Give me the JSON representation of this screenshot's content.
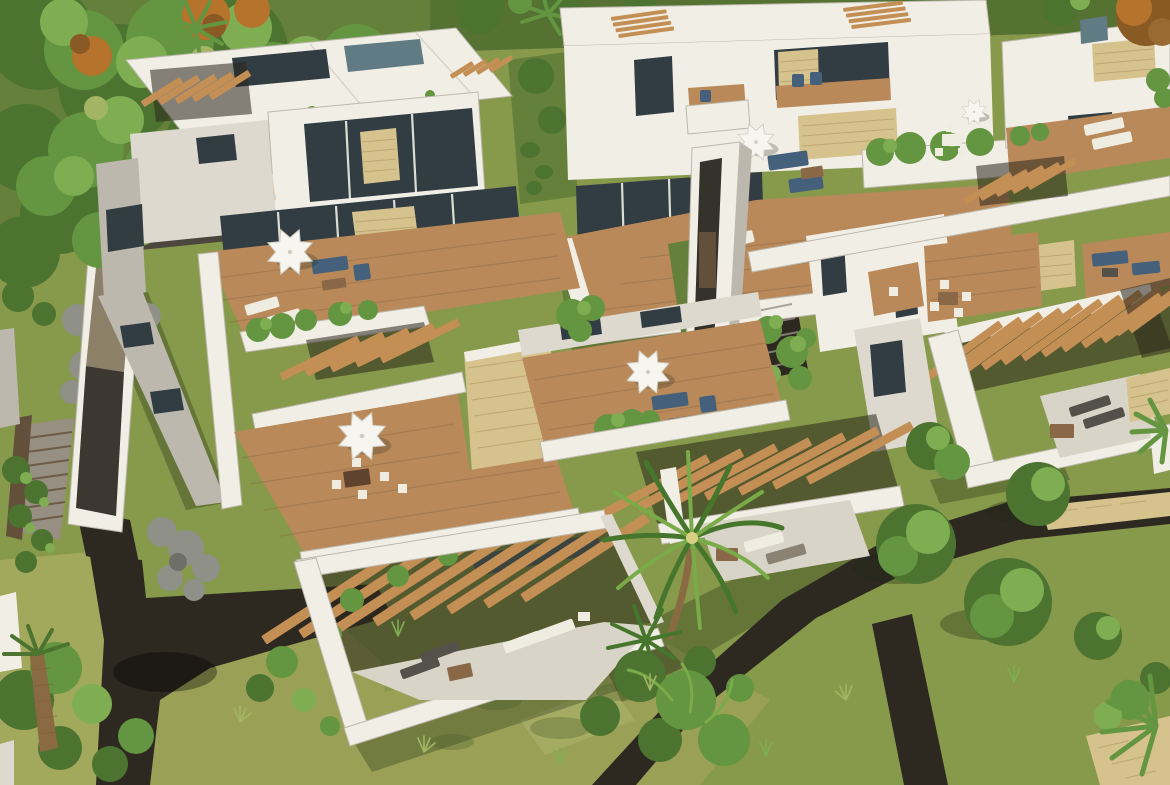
{
  "meta": {
    "title": "Aerial 3D architectural rendering of a modern white residential complex",
    "view": "aerial three-quarter",
    "render_style": "photoreal CGI visualization",
    "canvas": {
      "width": 1170,
      "height": 785
    }
  },
  "palette": {
    "grassBase": "#87994a",
    "grassLight": "#a2a85c",
    "grassYellow": "#9aa156",
    "grassDark": "#64803a",
    "grassDeep": "#567233",
    "canopyDark": "#4c7330",
    "canopyMid": "#649540",
    "canopyLight": "#7fae52",
    "canopyPale": "#a3b564",
    "foliageOrange": "#b5732c",
    "foliageRust": "#8a5a24",
    "pathDark": "#2d2921",
    "wallLit": "#f1eee6",
    "wallMid": "#ded9ce",
    "wallShade": "#bcb8ad",
    "wallDark": "#a19c90",
    "deck": "#b9895a",
    "deckDark": "#8f6a42",
    "slat": "#c48f55",
    "stone": "#d6c28c",
    "stoneLine": "#a8925f",
    "glass": "#323c43",
    "glassLight": "#607b84",
    "furnitureBlue": "#45607b",
    "furnitureNavy": "#36506b",
    "furnitureWood": "#8a6847",
    "furnitureDark": "#54504a",
    "loungerWhite": "#efece2",
    "patioLight": "#d8d4c8",
    "pergolaShadow": "rgba(42,38,28,0.55)",
    "shadow": "rgba(30,42,18,0.32)",
    "rock": "#8f9088",
    "rockDark": "#6e6f68",
    "trunk": "#7b5a38",
    "palmTrunk": "#8a6a42",
    "palmFrond": "#46762c",
    "palmFrondLight": "#79ab49",
    "umbrellaWhite": "#f7f5ef",
    "umbrellaShade": "#cfccc1",
    "balustrade": "#9fb2bc",
    "stepLight": "#978f82",
    "earthBrown": "#63503a",
    "mottle": "rgba(70,90,40,0.30)",
    "stripe": "rgba(220,225,170,0.16)"
  },
  "scene": {
    "subject": "modern white multi-family villas with stepped rooftop terraces",
    "landscape": "tropical gardens with lawns, palms, round trees and dark gravel footpaths",
    "lighting": "bright sunlight from upper right, long soft shadows toward lower left",
    "features": {
      "white_parasols": 5,
      "timber_pergola_banks": 8,
      "stone_feature_walls": 7,
      "timber_deck_terraces": 8,
      "blue_outdoor_sofa_sets": 4,
      "white_sun_loungers": 10,
      "dark_sun_loungers": 4,
      "outdoor_dining_sets": 3,
      "palm_trees": 6,
      "round_garden_trees": 6,
      "rooftop_planters": "many",
      "elevated_white_walkway": 1,
      "outdoor_staircases": 2,
      "rock_garden_beds": 3,
      "dark_gravel_paths": "branching network"
    }
  }
}
